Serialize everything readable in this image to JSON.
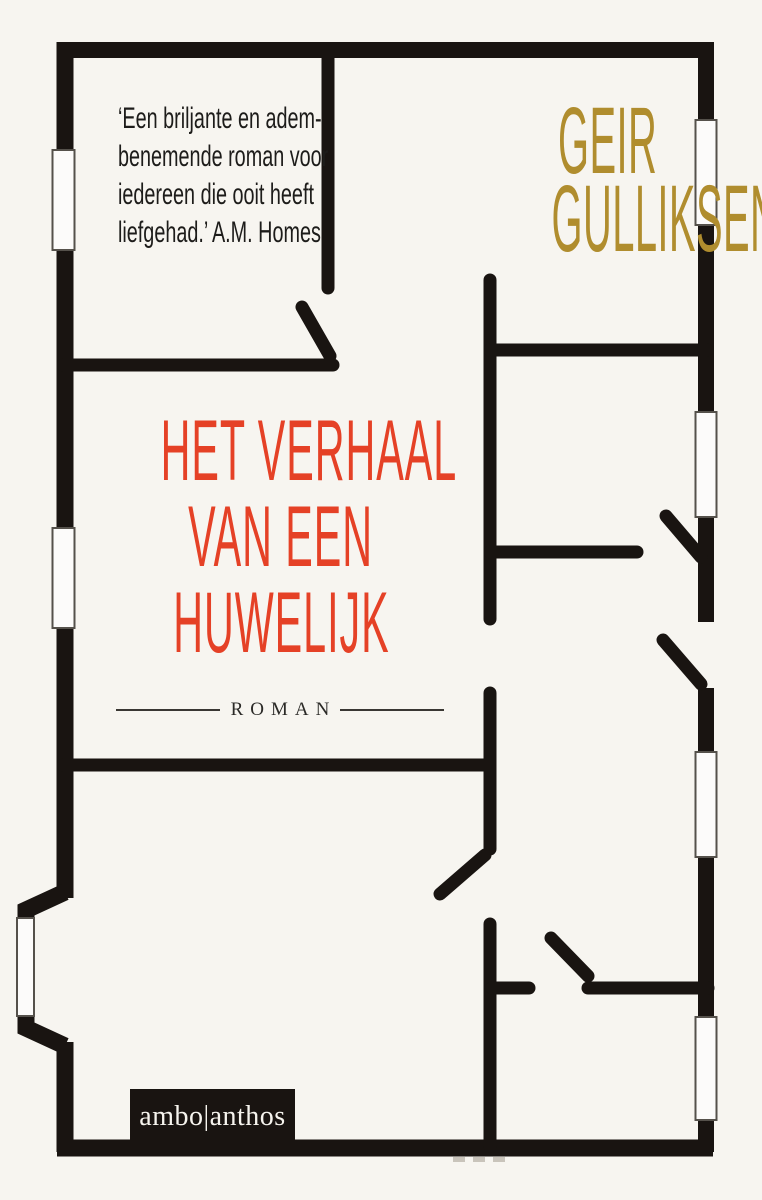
{
  "quote": {
    "lines": [
      "‘Een briljante en adem-",
      "benemende roman voor",
      "iedereen die ooit heeft",
      "liefgehad.’ A.M. Homes"
    ]
  },
  "author": {
    "lines": [
      "GEIR",
      "GULLIKSEN"
    ]
  },
  "title": {
    "lines": [
      "HET VERHAAL",
      "VAN EEN",
      "HUWELIJK"
    ]
  },
  "genre_label": "ROMAN",
  "publisher_logo": "ambo|anthos",
  "artwork": {
    "type": "apartment floor-plan line drawing",
    "windows": 7,
    "door_openings": 5
  },
  "colors": {
    "bg": "#f7f5f0",
    "wall": "#191411",
    "title": "#e54126",
    "author": "#b08d2e",
    "ink": "#1d1c1a",
    "logo_text": "#f6f4ee",
    "window_fill": "#fcfbfa",
    "window_stroke": "#55514b",
    "tick": "#c9c4bb"
  }
}
